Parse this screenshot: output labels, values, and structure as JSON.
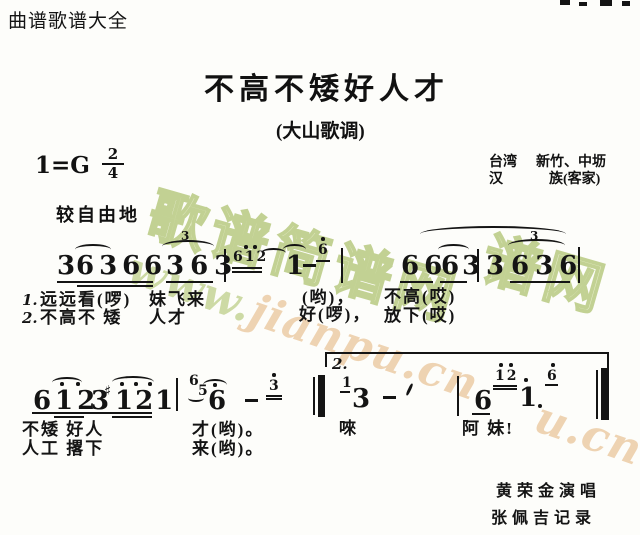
{
  "page": {
    "site_header": "曲谱歌谱大全",
    "title": "不高不矮好人才",
    "subtitle": "(大山歌调)",
    "key_signature": "1=G",
    "meter_numerator": "2",
    "meter_denominator": "4",
    "tempo": "较自由地",
    "origin": {
      "region": "台湾",
      "place": "新竹、中坜",
      "ethnic": "汉",
      "ethnic2": "族(客家)"
    },
    "credits": {
      "singer": "黄荣金演唱",
      "transcriber": "张佩吉记录"
    }
  },
  "watermark": {
    "bubble_text": "歌谱简谱网",
    "bubble_partial": "谱网",
    "script_prefix": "www.",
    "script_main": "jianpu.cn",
    "script_fragment": "u.cn",
    "bubble_fill": "#e6edc9",
    "bubble_outline": "#c2d193",
    "script_green": "#cddaa5",
    "script_tan": "#eed3b2"
  },
  "score": {
    "s1": {
      "a": "3",
      "b": "636",
      "c": "6",
      "d": "363",
      "t1": "3",
      "gr1": "612",
      "e": "1",
      "gr2": "6",
      "f": "66",
      "g": "63",
      "h": "3",
      "i": "636",
      "t2": "3"
    },
    "s2": {
      "a": "6",
      "b": "12",
      "c": "3",
      "sharp": "♯",
      "d": "121",
      "gr1": "6",
      "gr2": "5",
      "e": "6",
      "gr3": "3",
      "volta": "2.",
      "gr4": "1",
      "f": "3",
      "g": "6",
      "gr5": "12",
      "h": "1",
      "gr6": "6"
    },
    "lyrics": {
      "r1num": "1.",
      "r1a": "远远看(啰)",
      "r1b": "妹飞来",
      "r1c": "(哟)，",
      "r1d": "不高(哎)",
      "r2num": "2.",
      "r2a": "不高不 矮",
      "r2b": "人才",
      "r2c": "好(啰)，",
      "r2d": "放下(哎)",
      "r3a": "不矮 好人",
      "r3b": "才(哟)。",
      "r3c": "唻",
      "r3d": "阿 妹!",
      "r4a": "人工 撂下",
      "r4b": "来(哟)。"
    }
  }
}
